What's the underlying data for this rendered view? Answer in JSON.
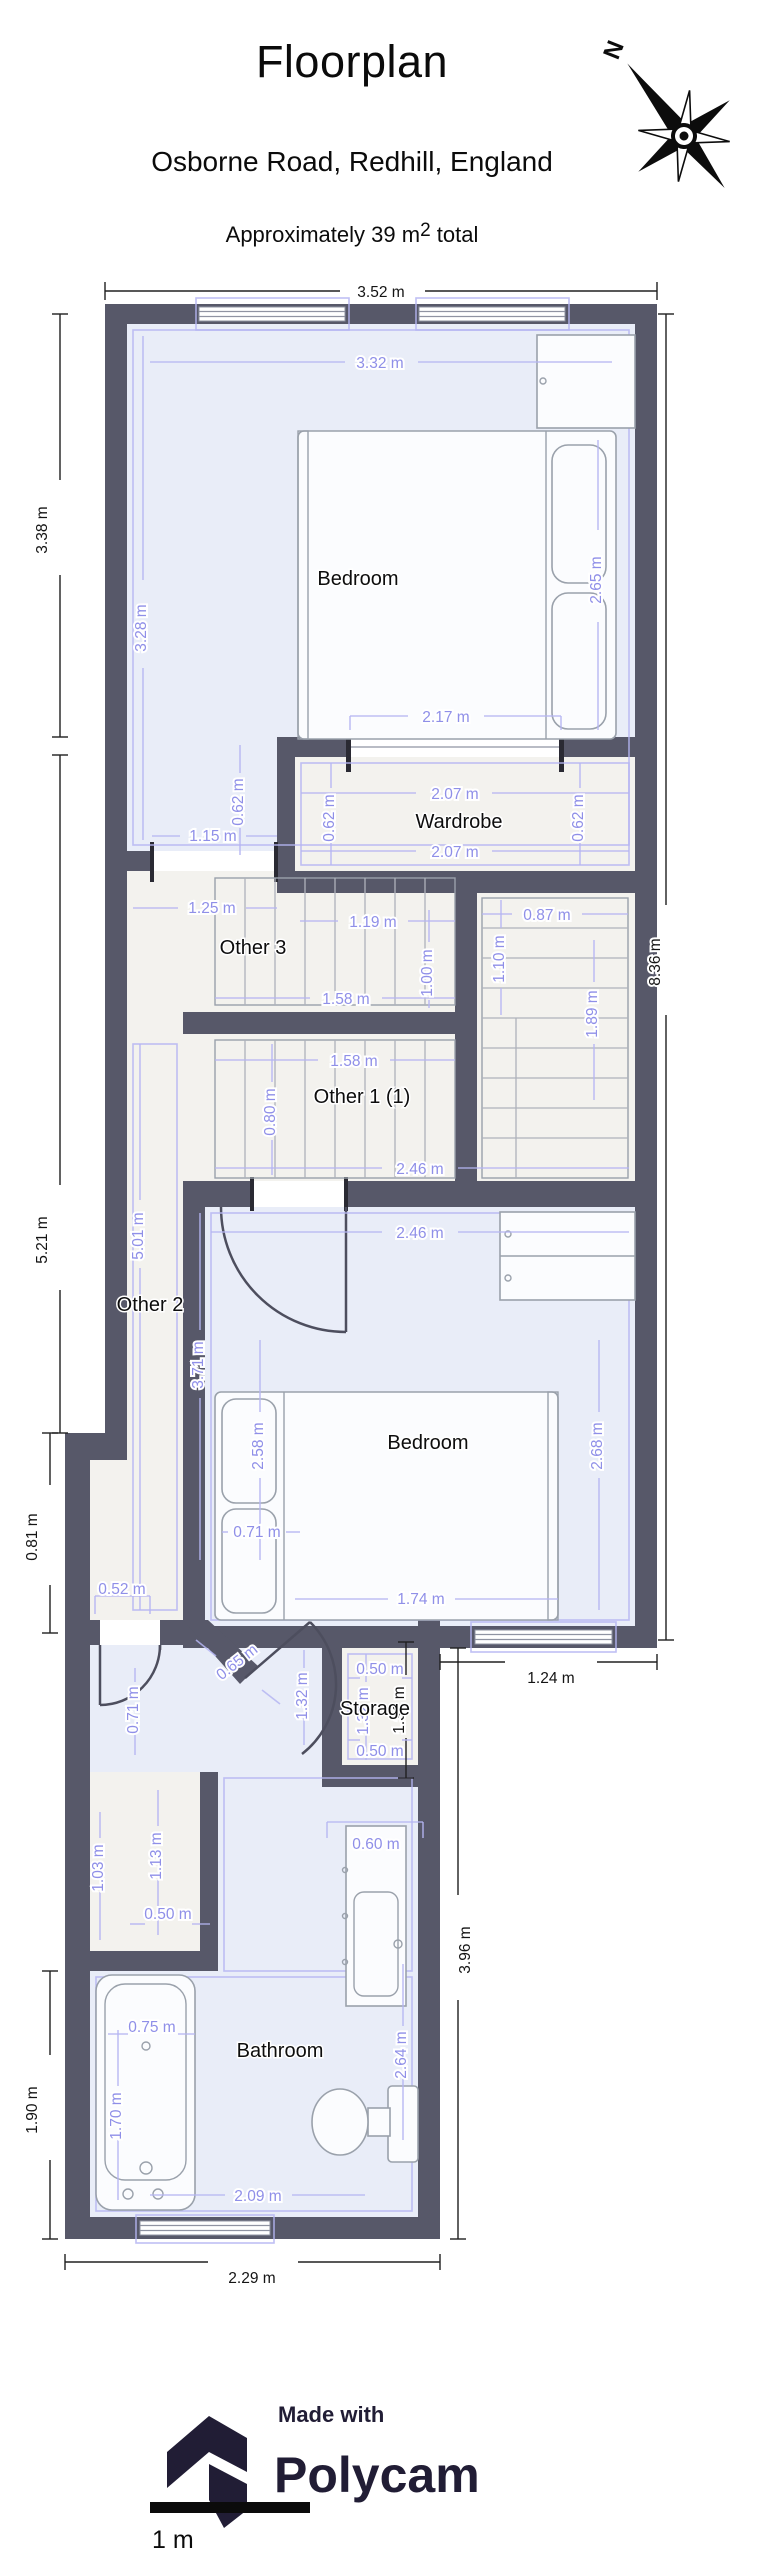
{
  "header": {
    "title": "Floorplan",
    "subtitle": "Osborne Road, Redhill, England",
    "area_prefix": "Approximately 39 m",
    "area_sup": "2",
    "area_suffix": " total",
    "compass_n": "N"
  },
  "rooms": {
    "bedroom1": "Bedroom",
    "wardrobe": "Wardrobe",
    "other3": "Other 3",
    "other1": "Other 1 (1)",
    "other2": "Other 2",
    "bedroom2": "Bedroom",
    "storage": "Storage",
    "bathroom": "Bathroom"
  },
  "dims": {
    "b1": "3.52 m",
    "b2": "3.38 m",
    "b3": "5.21 m",
    "b4": "8.36 m",
    "b5": "0.81 m",
    "b6": "1.90 m",
    "b7": "3.96 m",
    "b8": "1.24 m",
    "b9": "2.29 m",
    "b10": "1.31 m",
    "p1": "3.32 m",
    "p2": "3.28 m",
    "p3": "2.65 m",
    "p4": "2.17 m",
    "p5": "2.07 m",
    "p6": "2.07 m",
    "p7": "0.62 m",
    "p8": "0.62 m",
    "p9": "0.62 m",
    "p10": "1.15 m",
    "p11": "1.25 m",
    "p12": "1.19 m",
    "p13": "1.00 m",
    "p14": "1.58 m",
    "p15": "0.87 m",
    "p16": "1.10 m",
    "p17": "1.89 m",
    "p18": "1.58 m",
    "p19": "0.80 m",
    "p20": "2.46 m",
    "p21": "2.46 m",
    "p22": "5.01 m",
    "p23": "3.71 m",
    "p24": "2.58 m",
    "p25": "2.68 m",
    "p26": "0.71 m",
    "p27": "1.74 m",
    "p28": "0.52 m",
    "p29": "0.65 m",
    "p30": "0.71 m",
    "p31": "1.32 m",
    "p32": "0.50 m",
    "p33": "1.32 m",
    "p34": "0.50 m",
    "p35": "1.03 m",
    "p36": "1.13 m",
    "p37": "0.50 m",
    "p38": "0.60 m",
    "p39": "2.64 m",
    "p40": "0.75 m",
    "p41": "1.70 m",
    "p42": "2.09 m"
  },
  "footer": {
    "made_with": "Made with",
    "brand": "Polycam",
    "scale_label": "1 m"
  },
  "colors": {
    "wall": "#575869",
    "floor_blue": "#e9edf8",
    "floor_warm": "#f3f2ee",
    "dim_purple": "#8f8fe8",
    "dim_black": "#141414",
    "brand_dark": "#211d35"
  }
}
